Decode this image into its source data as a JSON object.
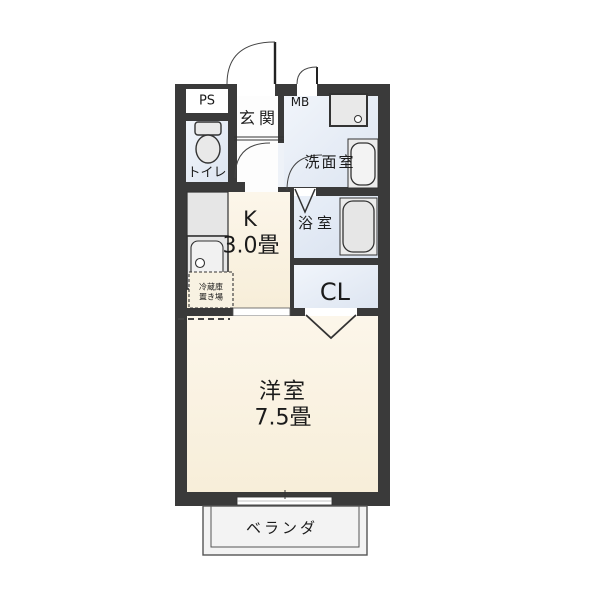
{
  "plan_type": "apartment-floorplan",
  "rooms": {
    "ps": {
      "label": "PS"
    },
    "toilet": {
      "label": "トイレ"
    },
    "entrance": {
      "label": "玄関"
    },
    "meter_box": {
      "label": "MB"
    },
    "washroom": {
      "label": "洗面室"
    },
    "kitchen": {
      "label": "K",
      "size": "3.0畳"
    },
    "bathroom": {
      "label": "浴室"
    },
    "closet": {
      "label": "CL"
    },
    "western_room": {
      "label": "洋室",
      "size": "7.5畳"
    },
    "veranda": {
      "label": "ベランダ"
    },
    "refrigerator_space": {
      "line1": "冷蔵庫",
      "line2": "置き場"
    }
  },
  "colors": {
    "wall": "#3a3a3a",
    "room_cream": "#faf2e0",
    "room_blue": "#e6ecf6",
    "hall_white": "#fdfdfd",
    "fixture_gray": "#e9e9e9",
    "veranda_fill": "#f3f3f3"
  }
}
